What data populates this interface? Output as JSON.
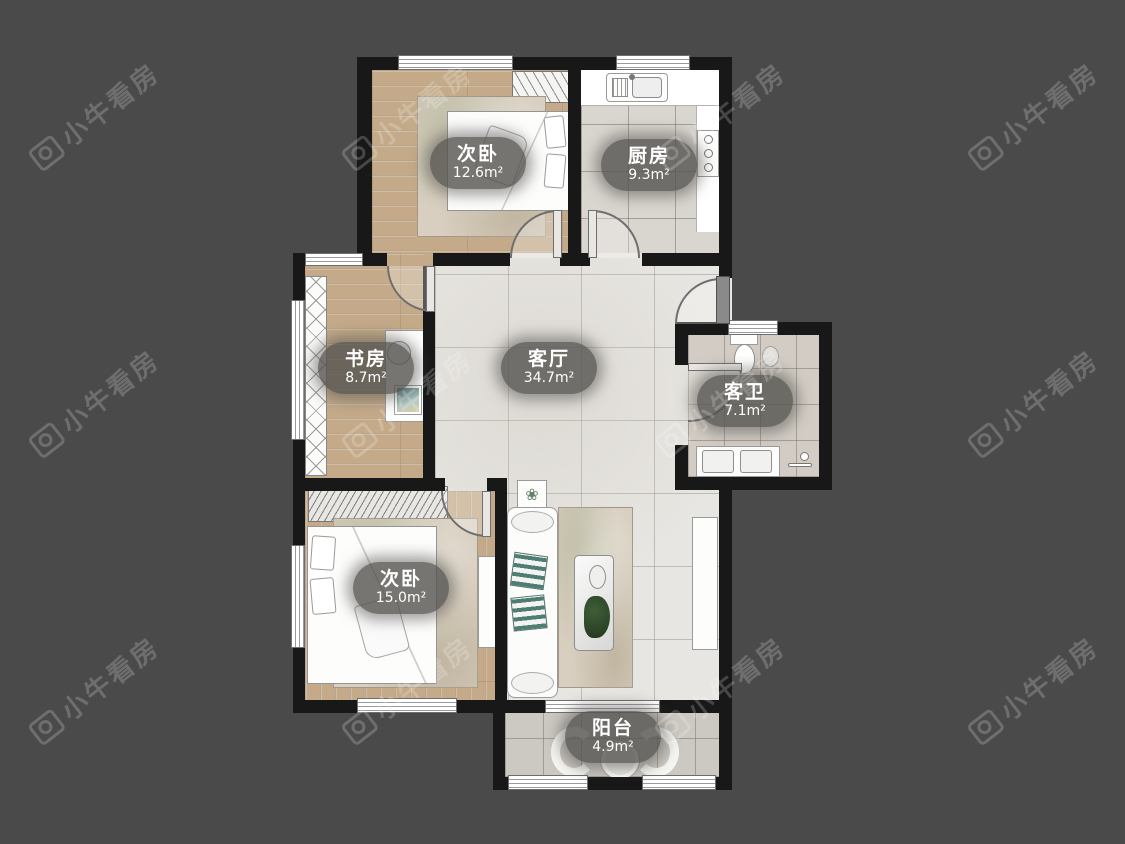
{
  "watermark": {
    "brand": "小牛看房"
  },
  "rooms": {
    "bedroom_top": {
      "name": "次卧",
      "area": "12.6m²"
    },
    "kitchen": {
      "name": "厨房",
      "area": "9.3m²"
    },
    "study": {
      "name": "书房",
      "area": "8.7m²"
    },
    "living": {
      "name": "客厅",
      "area": "34.7m²"
    },
    "bathroom": {
      "name": "客卫",
      "area": "7.1m²"
    },
    "bedroom_bottom": {
      "name": "次卧",
      "area": "15.0m²"
    },
    "balcony": {
      "name": "阳台",
      "area": "4.9m²"
    }
  },
  "icons": {
    "plant_box_flower": "❀"
  },
  "colors": {
    "background": "#4a4a4a",
    "wall": "#181818",
    "wood_floor": "#c4aa89",
    "living_tile": "#e8e6e2",
    "label_bubble": "rgba(84,82,79,0.8)",
    "watermark": "rgba(255,255,255,0.20)"
  }
}
